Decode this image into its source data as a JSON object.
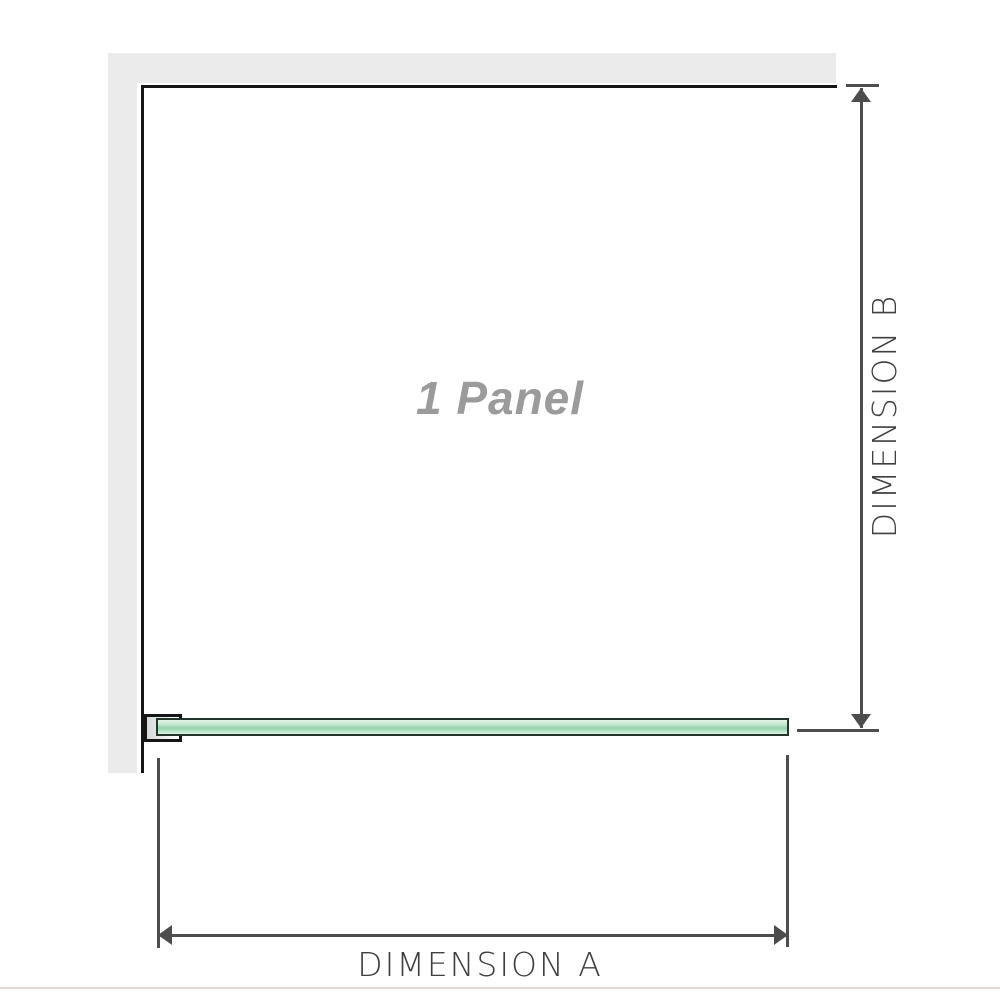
{
  "diagram": {
    "type": "shower-screen-plan-dimension-diagram",
    "panel_label": "1 Panel",
    "dimension_a_label": "DIMENSION A",
    "dimension_b_label": "DIMENSION B",
    "colors": {
      "background": "#ffffff",
      "wall_fill": "#ebebeb",
      "wall_edge": "#151515",
      "bracket_border": "#151515",
      "glass_border": "#22352a",
      "glass_fill_light": "#e4f4e8",
      "glass_fill_mid": "#94d2ab",
      "dimension_line": "#4d4d4d",
      "dimension_label_text": "#3f3f3f",
      "panel_label_text": "#9b9b9b",
      "bottom_edge_line": "#ddd8d1"
    }
  }
}
